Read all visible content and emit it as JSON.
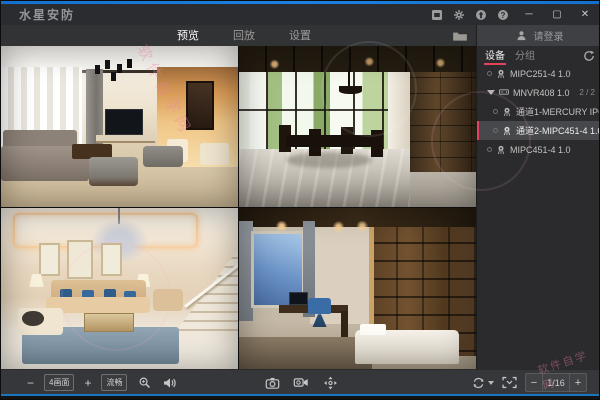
{
  "window": {
    "title": "水星安防",
    "controls": {
      "minimize": "─",
      "maximize": "▢",
      "close": "✕"
    }
  },
  "tabs": {
    "preview": "预览",
    "playback": "回放",
    "settings": "设置"
  },
  "login": {
    "label": "请登录"
  },
  "sidebar": {
    "tab_device": "设备",
    "tab_group": "分组",
    "devices": [
      {
        "label": "MIPC251-4 1.0",
        "type": "camera"
      },
      {
        "label": "MNVR408 1.0",
        "type": "nvr",
        "count": "2 / 2",
        "expanded": true
      },
      {
        "label": "通道1-MERCURY IPC",
        "type": "channel"
      },
      {
        "label": "通道2-MIPC451-4 1.0",
        "type": "channel",
        "selected": true
      },
      {
        "label": "MIPC451-4 1.0",
        "type": "camera"
      }
    ]
  },
  "toolbar": {
    "minus": "−",
    "plus": "+",
    "layout_label": "4画面",
    "stream_label": "流畅",
    "page_indicator": "1/16"
  },
  "watermark": {
    "site": "软件自学网"
  },
  "accent_colors": {
    "red": "#e5425c",
    "blue": "#1574d4"
  }
}
